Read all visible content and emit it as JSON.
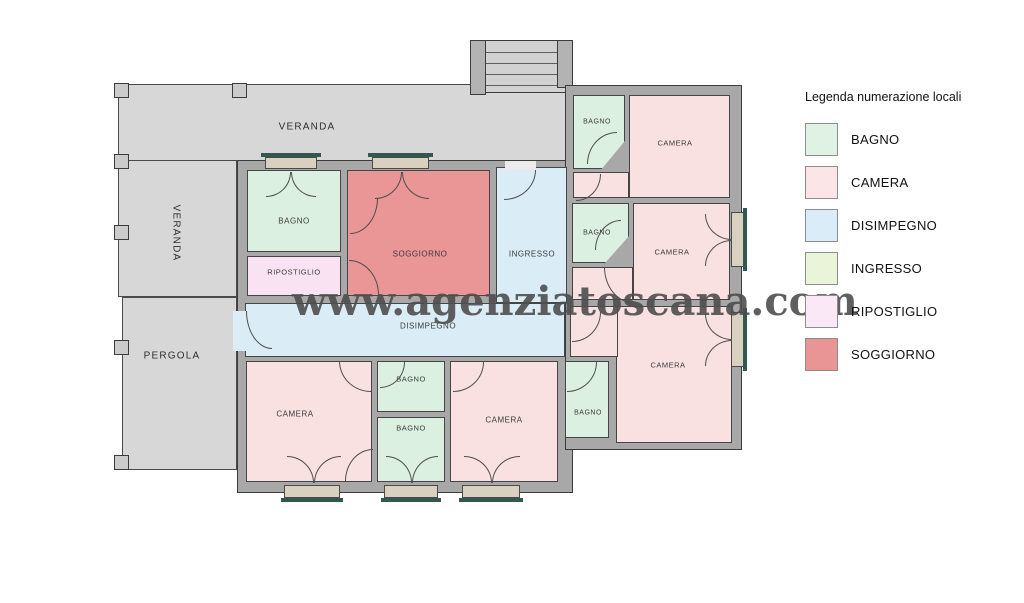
{
  "watermark": {
    "text": "www.agenziatoscana.com"
  },
  "legend": {
    "title": "Legenda numerazione locali",
    "items": [
      {
        "label": "BAGNO",
        "color": "#dff2e3"
      },
      {
        "label": "CAMERA",
        "color": "#fbe5e6"
      },
      {
        "label": "DISIMPEGNO",
        "color": "#daecf7"
      },
      {
        "label": "INGRESSO",
        "color": "#e9f4d9"
      },
      {
        "label": "RIPOSTIGLIO",
        "color": "#fbe8f6"
      },
      {
        "label": "SOGGIORNO",
        "color": "#e99596"
      }
    ]
  },
  "colors": {
    "bagno": "#dcf0e2",
    "camera": "#f9e0e1",
    "disimpegno": "#daecf6",
    "ingresso": "#daecf6",
    "ripostiglio": "#f9e3f2",
    "soggiorno": "#ea9596",
    "veranda": "#d7d7d7",
    "wall": "#a8a8a8",
    "sill": "#d9d0c0",
    "teal": "#33584f"
  },
  "plan": {
    "areas": [
      {
        "name": "veranda-top",
        "rect": [
          118,
          84,
          450,
          78
        ]
      },
      {
        "name": "veranda-left",
        "rect": [
          118,
          160,
          119,
          137
        ]
      },
      {
        "name": "pergola",
        "rect": [
          122,
          297,
          115,
          173
        ]
      }
    ],
    "outdoor_labels": [
      {
        "text": "VERANDA",
        "x": 307,
        "y": 127,
        "rotate": 0
      },
      {
        "text": "VERANDA",
        "x": 176,
        "y": 233,
        "rotate": 90
      },
      {
        "text": "PERGOLA",
        "x": 172,
        "y": 356,
        "rotate": 0
      }
    ],
    "pillars": {
      "size": 15,
      "positions": [
        [
          114,
          83
        ],
        [
          232,
          83
        ],
        [
          114,
          154
        ],
        [
          114,
          225
        ],
        [
          114,
          340
        ],
        [
          114,
          455
        ]
      ]
    },
    "stairs": {
      "box": [
        470,
        40,
        103,
        53
      ],
      "sidewalls": [
        [
          470,
          40,
          16,
          55
        ],
        [
          557,
          40,
          16,
          48
        ]
      ],
      "step_offsets": [
        12,
        23,
        34,
        45
      ]
    },
    "slabs": [
      {
        "name": "building-body-left",
        "rect": [
          237,
          160,
          336,
          333
        ]
      },
      {
        "name": "building-body-right",
        "rect": [
          565,
          85,
          177,
          365
        ]
      }
    ],
    "rooms": [
      {
        "name": "bagno-1",
        "label": "BAGNO",
        "fill": "bagno",
        "rect": [
          247,
          170,
          94,
          82
        ],
        "label_at": [
          294,
          221
        ],
        "fs": 8
      },
      {
        "name": "ripostiglio",
        "label": "RIPOSTIGLIO",
        "fill": "ripostiglio",
        "rect": [
          247,
          256,
          94,
          40
        ],
        "label_at": [
          294,
          272
        ],
        "fs": 7.5
      },
      {
        "name": "soggiorno",
        "label": "SOGGIORNO",
        "fill": "soggiorno",
        "rect": [
          347,
          170,
          143,
          126
        ],
        "label_at": [
          420,
          254
        ],
        "fs": 8
      },
      {
        "name": "ingresso",
        "label": "INGRESSO",
        "fill": "ingresso",
        "rect": [
          496,
          167,
          71,
          136
        ],
        "label_at": [
          532,
          254
        ],
        "fs": 8
      },
      {
        "name": "bagno-top",
        "label": "BAGNO",
        "fill": "bagno",
        "rect": [
          573,
          95,
          52,
          74
        ],
        "label_at": [
          597,
          122
        ],
        "fs": 7,
        "clip": "polygon(0 0,100% 0,100% 62%,55% 100%,0 100%)"
      },
      {
        "name": "camera-1",
        "label": "CAMERA",
        "fill": "camera",
        "rect": [
          629,
          95,
          101,
          103
        ],
        "label_at": [
          675,
          143
        ],
        "fs": 7.5
      },
      {
        "name": "camera-1-ext",
        "label": "",
        "fill": "camera",
        "rect": [
          573,
          172,
          56,
          26
        ],
        "label_at": [
          0,
          0
        ],
        "fs": 7
      },
      {
        "name": "bagno-2",
        "label": "BAGNO",
        "fill": "bagno",
        "rect": [
          572,
          203,
          57,
          60
        ],
        "label_at": [
          597,
          233
        ],
        "fs": 7,
        "clip": "polygon(0 0,100% 0,100% 55%,58% 100%,0 100%)"
      },
      {
        "name": "camera-2",
        "label": "CAMERA",
        "fill": "camera",
        "rect": [
          633,
          203,
          97,
          97
        ],
        "label_at": [
          672,
          252
        ],
        "fs": 7.5
      },
      {
        "name": "camera-2-ext",
        "label": "",
        "fill": "camera",
        "rect": [
          572,
          267,
          61,
          33
        ],
        "label_at": [
          0,
          0
        ],
        "fs": 7
      },
      {
        "name": "disimpegno",
        "label": "DISIMPEGNO",
        "fill": "disimpegno",
        "rect": [
          245,
          303,
          320,
          54
        ],
        "label_at": [
          428,
          326
        ],
        "fs": 8
      },
      {
        "name": "camera-3",
        "label": "CAMERA",
        "fill": "camera",
        "rect": [
          616,
          306,
          116,
          137
        ],
        "label_at": [
          668,
          365
        ],
        "fs": 7.5
      },
      {
        "name": "camera-3-ext",
        "label": "",
        "fill": "camera",
        "rect": [
          570,
          306,
          48,
          51
        ],
        "label_at": [
          0,
          0
        ],
        "fs": 7
      },
      {
        "name": "camera-bl",
        "label": "CAMERA",
        "fill": "camera",
        "rect": [
          246,
          361,
          126,
          121
        ],
        "label_at": [
          295,
          414
        ],
        "fs": 8
      },
      {
        "name": "bagno-m1",
        "label": "BAGNO",
        "fill": "bagno",
        "rect": [
          377,
          361,
          68,
          51
        ],
        "label_at": [
          411,
          379
        ],
        "fs": 7.5
      },
      {
        "name": "bagno-m2",
        "label": "BAGNO",
        "fill": "bagno",
        "rect": [
          377,
          417,
          68,
          65
        ],
        "label_at": [
          411,
          428
        ],
        "fs": 7.5
      },
      {
        "name": "camera-bc",
        "label": "CAMERA",
        "fill": "camera",
        "rect": [
          450,
          361,
          108,
          121
        ],
        "label_at": [
          504,
          420
        ],
        "fs": 8
      },
      {
        "name": "bagno-br",
        "label": "BAGNO",
        "fill": "bagno",
        "rect": [
          565,
          361,
          44,
          77
        ],
        "label_at": [
          588,
          413
        ],
        "fs": 7
      }
    ],
    "sills": [
      {
        "name": "sill-top-1",
        "rect": [
          265,
          157,
          52,
          12
        ]
      },
      {
        "name": "sill-top-2",
        "rect": [
          372,
          157,
          57,
          12
        ]
      },
      {
        "name": "sill-bottom-1",
        "rect": [
          284,
          485,
          56,
          13
        ]
      },
      {
        "name": "sill-bottom-2",
        "rect": [
          384,
          485,
          54,
          13
        ]
      },
      {
        "name": "sill-bottom-3",
        "rect": [
          462,
          485,
          58,
          13
        ]
      },
      {
        "name": "sill-right-1",
        "rect": [
          731,
          212,
          13,
          55
        ]
      },
      {
        "name": "sill-right-2",
        "rect": [
          731,
          312,
          13,
          55
        ]
      }
    ],
    "teal_strips": [
      [
        261,
        153,
        60,
        4
      ],
      [
        368,
        153,
        65,
        4
      ],
      [
        281,
        498,
        62,
        4
      ],
      [
        381,
        498,
        60,
        4
      ],
      [
        459,
        498,
        64,
        4
      ],
      [
        743,
        208,
        4,
        63
      ],
      [
        743,
        308,
        4,
        63
      ]
    ],
    "openings": [
      {
        "name": "opening-ingresso-entry",
        "rect": [
          505,
          161,
          31,
          9
        ],
        "fill": "#ebebeb"
      },
      {
        "name": "opening-pergola-door",
        "rect": [
          233,
          311,
          13,
          40
        ],
        "fill": "#daecf6"
      }
    ],
    "doors": [
      {
        "rect": [
          266,
          172,
          25,
          25
        ],
        "hinge": "tl"
      },
      {
        "rect": [
          291,
          172,
          25,
          25
        ],
        "hinge": "tr"
      },
      {
        "rect": [
          375,
          172,
          27,
          27
        ],
        "hinge": "tl"
      },
      {
        "rect": [
          402,
          172,
          27,
          27
        ],
        "hinge": "tr"
      },
      {
        "rect": [
          504,
          170,
          32,
          30
        ],
        "hinge": "tl"
      },
      {
        "rect": [
          350,
          198,
          28,
          36
        ],
        "hinge": "tl"
      },
      {
        "rect": [
          349,
          260,
          30,
          35
        ],
        "hinge": "bl"
      },
      {
        "rect": [
          246,
          311,
          26,
          38
        ],
        "hinge": "tr"
      },
      {
        "rect": [
          576,
          174,
          25,
          27
        ],
        "hinge": "tl"
      },
      {
        "rect": [
          587,
          132,
          30,
          32
        ],
        "hinge": "br"
      },
      {
        "rect": [
          595,
          220,
          26,
          30
        ],
        "hinge": "br"
      },
      {
        "rect": [
          604,
          267,
          29,
          36
        ],
        "hinge": "tr"
      },
      {
        "rect": [
          572,
          312,
          29,
          30
        ],
        "hinge": "tl"
      },
      {
        "rect": [
          339,
          361,
          32,
          31
        ],
        "hinge": "tr"
      },
      {
        "rect": [
          380,
          362,
          25,
          26
        ],
        "hinge": "tl"
      },
      {
        "rect": [
          345,
          449,
          28,
          32
        ],
        "hinge": "br"
      },
      {
        "rect": [
          453,
          362,
          31,
          30
        ],
        "hinge": "tl"
      },
      {
        "rect": [
          567,
          362,
          30,
          30
        ],
        "hinge": "tl"
      },
      {
        "rect": [
          287,
          456,
          27,
          27
        ],
        "hinge": "bl"
      },
      {
        "rect": [
          314,
          456,
          27,
          27
        ],
        "hinge": "br"
      },
      {
        "rect": [
          386,
          456,
          26,
          27
        ],
        "hinge": "bl"
      },
      {
        "rect": [
          412,
          456,
          26,
          27
        ],
        "hinge": "br"
      },
      {
        "rect": [
          464,
          456,
          28,
          27
        ],
        "hinge": "bl"
      },
      {
        "rect": [
          492,
          456,
          28,
          27
        ],
        "hinge": "br"
      },
      {
        "rect": [
          705,
          214,
          27,
          26
        ],
        "hinge": "tr"
      },
      {
        "rect": [
          705,
          240,
          27,
          26
        ],
        "hinge": "br"
      },
      {
        "rect": [
          705,
          314,
          27,
          26
        ],
        "hinge": "tr"
      },
      {
        "rect": [
          705,
          340,
          27,
          26
        ],
        "hinge": "br"
      }
    ],
    "watermark_pos": {
      "x": 292,
      "y": 278
    }
  }
}
